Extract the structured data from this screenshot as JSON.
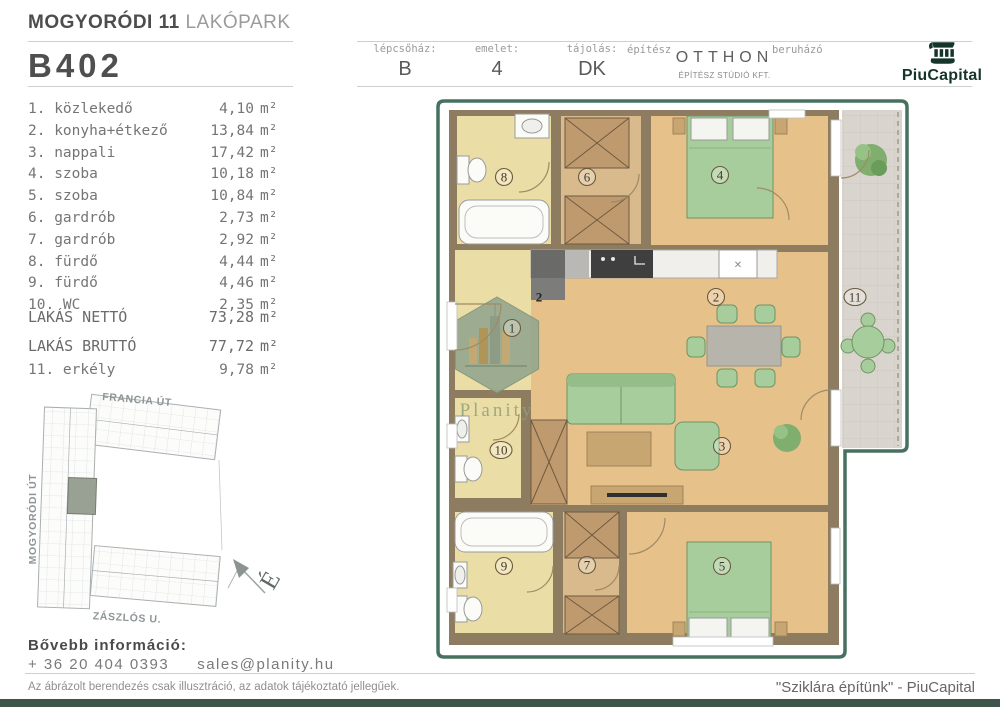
{
  "header": {
    "project_title_bold": "MOGYORÓDI 11",
    "project_title_light": "LAKÓPARK",
    "unit_id": "B402",
    "info_columns": [
      {
        "label": "lépcsőház:",
        "value": "B"
      },
      {
        "label": "emelet:",
        "value": "4"
      },
      {
        "label": "tájolás:",
        "value": "DK"
      }
    ],
    "architect_label": "építész",
    "architect_name": "OTTHON",
    "architect_sub": "ÉPÍTÉSZ STÚDIÓ KFT.",
    "developer_label": "beruházó",
    "developer_name": "PiuCapital"
  },
  "room_list": [
    {
      "num": "1.",
      "name": "közlekedő",
      "area": "4,10",
      "unit": "m²"
    },
    {
      "num": "2.",
      "name": "konyha+étkező",
      "area": "13,84",
      "unit": "m²"
    },
    {
      "num": "3.",
      "name": "nappali",
      "area": "17,42",
      "unit": "m²"
    },
    {
      "num": "4.",
      "name": "szoba",
      "area": "10,18",
      "unit": "m²"
    },
    {
      "num": "5.",
      "name": "szoba",
      "area": "10,84",
      "unit": "m²"
    },
    {
      "num": "6.",
      "name": "gardrób",
      "area": "2,73",
      "unit": "m²"
    },
    {
      "num": "7.",
      "name": "gardrób",
      "area": "2,92",
      "unit": "m²"
    },
    {
      "num": "8.",
      "name": "fürdő",
      "area": "4,44",
      "unit": "m²"
    },
    {
      "num": "9.",
      "name": "fürdő",
      "area": "4,46",
      "unit": "m²"
    },
    {
      "num": "10.",
      "name": "WC",
      "area": "2,35",
      "unit": "m²"
    }
  ],
  "totals": [
    {
      "label": "LAKÁS NETTÓ",
      "area": "73,28",
      "unit": "m²"
    },
    {
      "label": "LAKÁS BRUTTÓ",
      "area": "77,72",
      "unit": "m²"
    }
  ],
  "extra_room": {
    "num": "11.",
    "name": "erkély",
    "area": "9,78",
    "unit": "m²"
  },
  "site_map": {
    "street_top": "FRANCIA ÚT",
    "street_left": "MOGYORÓDI ÚT",
    "street_bottom": "ZÁSZLÓS U.",
    "compass_letter": "É"
  },
  "contact": {
    "heading": "Bővebb információ:",
    "phone": "+ 36 20 404 0393",
    "email": "sales@planity.hu"
  },
  "footer": {
    "disclaimer": "Az ábrázolt berendezés csak illusztráció, az adatok tájékoztató jellegűek.",
    "slogan": "\"Sziklára építünk\" - PiuCapital"
  },
  "floor_plan": {
    "watermark": "Planity",
    "labels": [
      {
        "n": "1",
        "x": 77,
        "y": 230
      },
      {
        "n": "2",
        "x": 281,
        "y": 199
      },
      {
        "n": "2",
        "x": 104,
        "y": 199,
        "plain": true
      },
      {
        "n": "3",
        "x": 287,
        "y": 348
      },
      {
        "n": "4",
        "x": 285,
        "y": 77
      },
      {
        "n": "5",
        "x": 287,
        "y": 468
      },
      {
        "n": "6",
        "x": 152,
        "y": 79
      },
      {
        "n": "7",
        "x": 152,
        "y": 467
      },
      {
        "n": "8",
        "x": 69,
        "y": 79
      },
      {
        "n": "9",
        "x": 69,
        "y": 468
      },
      {
        "n": "10",
        "x": 66,
        "y": 352
      },
      {
        "n": "11",
        "x": 420,
        "y": 199
      }
    ],
    "colors": {
      "plan_border": "#46705f",
      "wall": "#8d7c60",
      "wood_floor": "#e6c18a",
      "wet_floor": "#ebdda6",
      "furniture_green": "#a8cd9c",
      "brand_green": "#16352a",
      "bottom_bar": "#3f5549"
    }
  }
}
